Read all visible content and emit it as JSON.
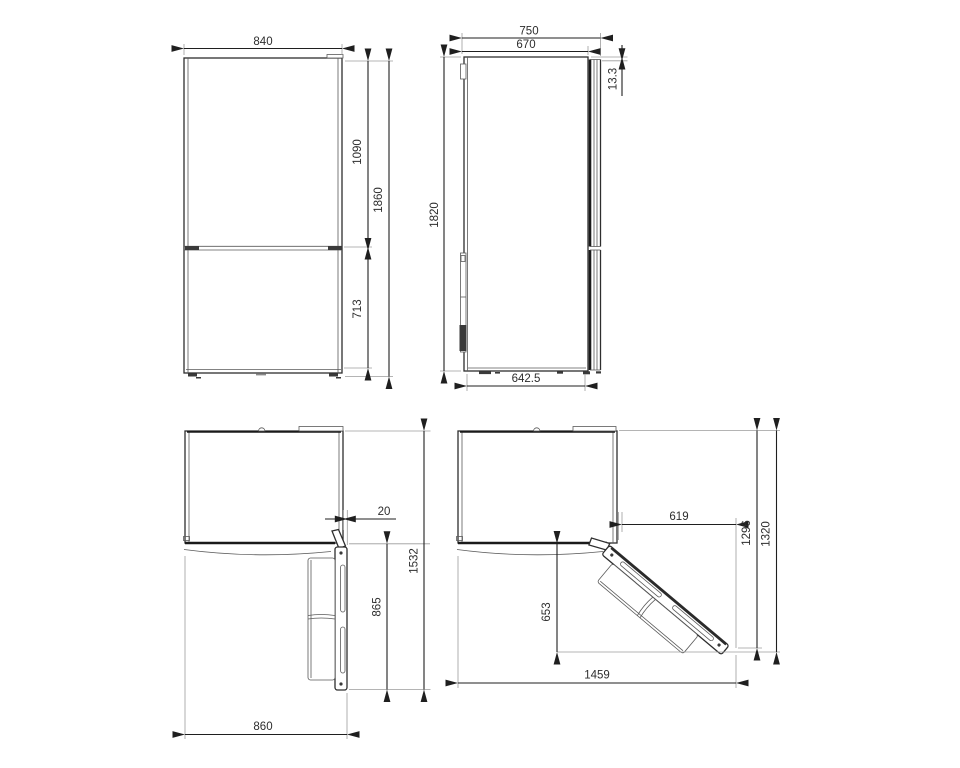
{
  "drawing": {
    "kind": "appliance-dimension-diagram",
    "subject": "refrigerator technical drawing, four orthographic views with dimensions",
    "colors": {
      "background": "#ffffff",
      "outline": "#2e2e2e",
      "heavy_line": "#1a1a1a",
      "extension_line": "#9b9b9b",
      "dimension_text": "#2d2d2d"
    },
    "views": {
      "front": {
        "label": "front view",
        "width": "840",
        "upper_door_height": "1090",
        "total_height": "1860",
        "lower_door_height": "713"
      },
      "side": {
        "label": "side view",
        "total_depth": "750",
        "body_depth": "670",
        "door_top_offset": "13.3",
        "height": "1820",
        "base_depth": "642.5"
      },
      "plan_open_90": {
        "label": "top view, door open 90°",
        "door_side_clearance": "20",
        "total_depth_door_open": "1532",
        "door_projection": "865",
        "total_width": "860"
      },
      "plan_open_135": {
        "label": "top view, door open wide",
        "door_swing_width": "619",
        "depth_to_door_edge": "1296",
        "total_depth": "1320",
        "door_projection": "653",
        "total_width_open": "1459"
      }
    }
  }
}
